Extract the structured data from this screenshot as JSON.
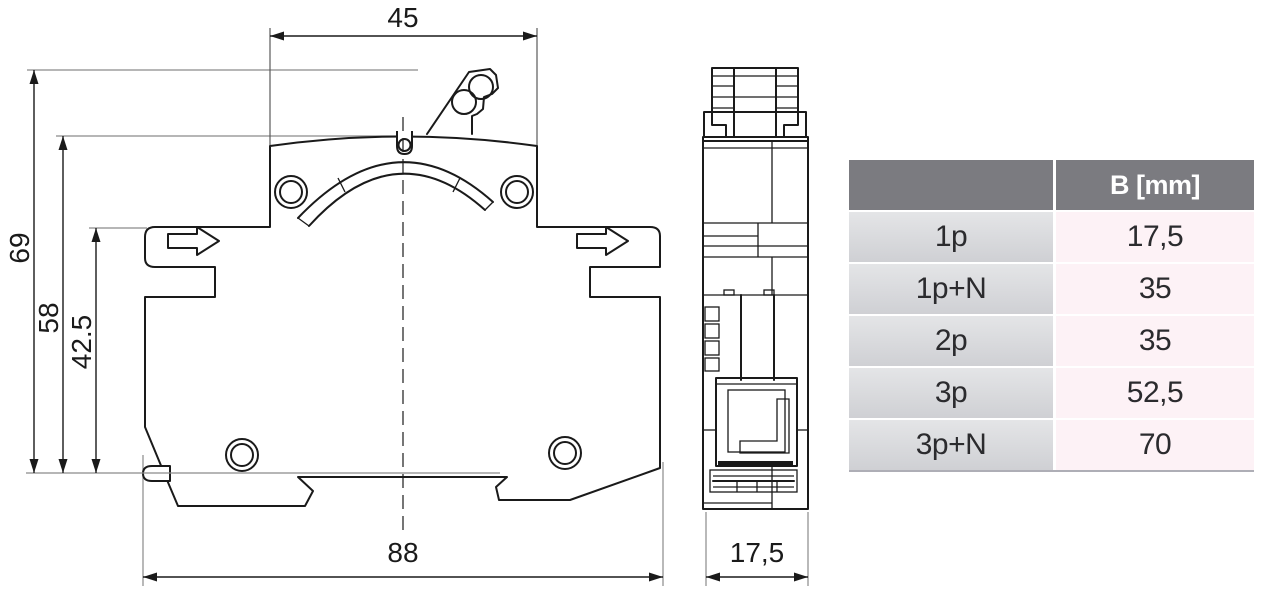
{
  "dimensions": {
    "top_width": "45",
    "total_height": "69",
    "upper_height": "58",
    "lower_height": "42.5",
    "total_width": "88",
    "depth": "17,5"
  },
  "table": {
    "header": {
      "parameter_label": "",
      "value_label": "B [mm]"
    },
    "rows": [
      {
        "label": "1p",
        "value": "17,5"
      },
      {
        "label": "1p+N",
        "value": "35"
      },
      {
        "label": "2p",
        "value": "35"
      },
      {
        "label": "3p",
        "value": "52,5"
      },
      {
        "label": "3p+N",
        "value": "70"
      }
    ]
  },
  "colors": {
    "background": "#ffffff",
    "part_line": "#1a1a1a",
    "extension_line": "#8a8a8a",
    "table_header_bg": "#7b7b80",
    "table_header_text": "#ffffff",
    "table_label_cell_top": "#e4e5e7",
    "table_label_cell_bottom": "#cfd0d4",
    "table_value_cell_bg": "#fdf2f6",
    "table_text": "#2b2b2e",
    "table_separator": "#aeaeb6"
  }
}
